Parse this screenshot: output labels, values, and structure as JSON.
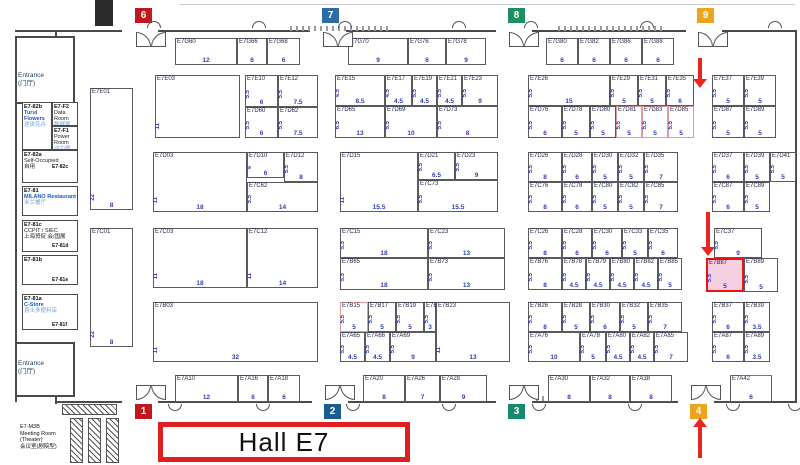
{
  "hall_label": "Hall E7",
  "colors": {
    "wall": "#4a4a4a",
    "booth_number_blue": "#2f3fb5",
    "highlight_fill": "#f6cfe3",
    "highlight_border": "#ee1212",
    "arrow_red": "#e8251f",
    "hall_label_border": "#e02020"
  },
  "badges": [
    {
      "n": "6",
      "color": "#c0181c",
      "x": 135,
      "y": 8
    },
    {
      "n": "7",
      "color": "#2c6da6",
      "x": 322,
      "y": 8
    },
    {
      "n": "8",
      "color": "#1e9060",
      "x": 508,
      "y": 8
    },
    {
      "n": "9",
      "color": "#eda31b",
      "x": 697,
      "y": 8
    },
    {
      "n": "1",
      "color": "#c0181c",
      "x": 135,
      "y": 404
    },
    {
      "n": "2",
      "color": "#1c5d8f",
      "x": 324,
      "y": 404
    },
    {
      "n": "3",
      "color": "#158a70",
      "x": 508,
      "y": 404
    },
    {
      "n": "4",
      "color": "#eda31b",
      "x": 690,
      "y": 404
    }
  ],
  "arrows": [
    {
      "x": 700,
      "y": 58,
      "h": 30,
      "dir": "down"
    },
    {
      "x": 708,
      "y": 212,
      "h": 44,
      "dir": "down"
    },
    {
      "x": 700,
      "y": 418,
      "h": 40,
      "dir": "up"
    }
  ],
  "booths": [
    {
      "id": "E7G60",
      "x": 175,
      "y": 38,
      "w": 62,
      "h": 27,
      "d": "",
      "n": "12"
    },
    {
      "id": "E7G66",
      "x": 237,
      "y": 38,
      "w": 30,
      "h": 27,
      "d": "",
      "n": "6"
    },
    {
      "id": "E7G68",
      "x": 267,
      "y": 38,
      "w": 33,
      "h": 27,
      "d": "",
      "n": "6"
    },
    {
      "id": "E7G70",
      "x": 348,
      "y": 38,
      "w": 60,
      "h": 27,
      "d": "",
      "n": "9"
    },
    {
      "id": "E7G76",
      "x": 408,
      "y": 38,
      "w": 38,
      "h": 27,
      "d": "",
      "n": "6"
    },
    {
      "id": "E7G78",
      "x": 446,
      "y": 38,
      "w": 40,
      "h": 27,
      "d": "",
      "n": "9"
    },
    {
      "id": "E7G80",
      "x": 546,
      "y": 38,
      "w": 32,
      "h": 27,
      "d": "",
      "n": "6"
    },
    {
      "id": "E7G82",
      "x": 578,
      "y": 38,
      "w": 32,
      "h": 27,
      "d": "",
      "n": "6"
    },
    {
      "id": "E7G86",
      "x": 610,
      "y": 38,
      "w": 32,
      "h": 27,
      "d": "",
      "n": "6"
    },
    {
      "id": "E7G88",
      "x": 642,
      "y": 38,
      "w": 32,
      "h": 27,
      "d": "",
      "n": "6"
    },
    {
      "id": "E7E01",
      "x": 90,
      "y": 88,
      "w": 43,
      "h": 122,
      "d": "22",
      "n": "8"
    },
    {
      "id": "E7C01",
      "x": 90,
      "y": 228,
      "w": 43,
      "h": 119,
      "d": "22",
      "n": "8"
    },
    {
      "id": "E7E03",
      "x": 155,
      "y": 75,
      "w": 85,
      "h": 63,
      "d": "11",
      "n": ""
    },
    {
      "id": "E7E10",
      "x": 245,
      "y": 75,
      "w": 33,
      "h": 32,
      "d": "5.5",
      "n": "6"
    },
    {
      "id": "E7E12",
      "x": 278,
      "y": 75,
      "w": 40,
      "h": 32,
      "d": "5.5",
      "n": "7.5"
    },
    {
      "id": "E7D60",
      "x": 245,
      "y": 107,
      "w": 33,
      "h": 31,
      "d": "5.5",
      "n": "6"
    },
    {
      "id": "E7D62",
      "x": 278,
      "y": 107,
      "w": 40,
      "h": 31,
      "d": "5.5",
      "n": "7.5"
    },
    {
      "id": "E7E15",
      "x": 335,
      "y": 75,
      "w": 50,
      "h": 31,
      "d": "4.5",
      "n": "8.5"
    },
    {
      "id": "E7E17",
      "x": 385,
      "y": 75,
      "w": 27,
      "h": 31,
      "d": "4.5",
      "n": "4.5"
    },
    {
      "id": "E7E19",
      "x": 412,
      "y": 75,
      "w": 25,
      "h": 31,
      "d": "5.5",
      "n": "4.5"
    },
    {
      "id": "E7E21",
      "x": 437,
      "y": 75,
      "w": 25,
      "h": 31,
      "d": "5.5",
      "n": "4.5"
    },
    {
      "id": "E7E23",
      "x": 462,
      "y": 75,
      "w": 36,
      "h": 31,
      "d": "5.5",
      "n": "9"
    },
    {
      "id": "E7D65",
      "x": 335,
      "y": 106,
      "w": 50,
      "h": 32,
      "d": "6.5",
      "n": "13"
    },
    {
      "id": "E7D69",
      "x": 385,
      "y": 106,
      "w": 52,
      "h": 32,
      "d": "5.5",
      "n": "10"
    },
    {
      "id": "E7D73",
      "x": 437,
      "y": 106,
      "w": 61,
      "h": 32,
      "d": "5.5",
      "n": "8"
    },
    {
      "id": "E7E26",
      "x": 528,
      "y": 75,
      "w": 82,
      "h": 31,
      "d": "5.5",
      "n": "15"
    },
    {
      "id": "E7E29",
      "x": 610,
      "y": 75,
      "w": 28,
      "h": 31,
      "d": "5.5",
      "n": "5"
    },
    {
      "id": "E7E31",
      "x": 638,
      "y": 75,
      "w": 28,
      "h": 31,
      "d": "5.5",
      "n": "5"
    },
    {
      "id": "E7E35",
      "x": 666,
      "y": 75,
      "w": 28,
      "h": 31,
      "d": "5.5",
      "n": "6"
    },
    {
      "id": "E7D76",
      "x": 528,
      "y": 106,
      "w": 34,
      "h": 32,
      "d": "5.5",
      "n": "6"
    },
    {
      "id": "E7D78",
      "x": 562,
      "y": 106,
      "w": 28,
      "h": 32,
      "d": "5.5",
      "n": "5"
    },
    {
      "id": "E7D80",
      "x": 590,
      "y": 106,
      "w": 26,
      "h": 32,
      "d": "5.5",
      "n": "5"
    },
    {
      "id": "E7D81",
      "x": 616,
      "y": 106,
      "w": 26,
      "h": 32,
      "d": "5.5",
      "n": "5",
      "cls": "pink"
    },
    {
      "id": "E7D83",
      "x": 642,
      "y": 106,
      "w": 26,
      "h": 32,
      "d": "5.5",
      "n": "5",
      "cls": "pink"
    },
    {
      "id": "E7D85",
      "x": 668,
      "y": 106,
      "w": 26,
      "h": 32,
      "d": "5.5",
      "n": "5",
      "cls": "pink"
    },
    {
      "id": "E7E37",
      "x": 712,
      "y": 75,
      "w": 32,
      "h": 31,
      "d": "5.5",
      "n": "5"
    },
    {
      "id": "E7E39",
      "x": 744,
      "y": 75,
      "w": 32,
      "h": 31,
      "d": "5.5",
      "n": "5"
    },
    {
      "id": "E7D87",
      "x": 712,
      "y": 106,
      "w": 32,
      "h": 32,
      "d": "5.5",
      "n": "5"
    },
    {
      "id": "E7D89",
      "x": 744,
      "y": 106,
      "w": 32,
      "h": 32,
      "d": "5.5",
      "n": "5"
    },
    {
      "id": "E7D03",
      "x": 153,
      "y": 152,
      "w": 94,
      "h": 60,
      "d": "11",
      "n": "18"
    },
    {
      "id": "E7D10",
      "x": 247,
      "y": 152,
      "w": 37,
      "h": 26,
      "d": "4",
      "n": "6"
    },
    {
      "id": "E7D12",
      "x": 284,
      "y": 152,
      "w": 34,
      "h": 30,
      "d": "5.5",
      "n": "8"
    },
    {
      "id": "E7C62",
      "x": 247,
      "y": 182,
      "w": 71,
      "h": 30,
      "d": "5.5",
      "n": "14"
    },
    {
      "id": "E7D15",
      "x": 340,
      "y": 152,
      "w": 78,
      "h": 60,
      "d": "11",
      "n": "15.5"
    },
    {
      "id": "E7D21",
      "x": 418,
      "y": 152,
      "w": 37,
      "h": 28,
      "d": "5.5",
      "n": "6.5"
    },
    {
      "id": "E7D23",
      "x": 455,
      "y": 152,
      "w": 43,
      "h": 28,
      "d": "5.5",
      "n": "9"
    },
    {
      "id": "E7C73",
      "x": 418,
      "y": 180,
      "w": 80,
      "h": 32,
      "d": "5.5",
      "n": "15.5"
    },
    {
      "id": "E7D26",
      "x": 528,
      "y": 152,
      "w": 34,
      "h": 30,
      "d": "5.5",
      "n": "8"
    },
    {
      "id": "E7D28",
      "x": 562,
      "y": 152,
      "w": 30,
      "h": 30,
      "d": "5.5",
      "n": "6"
    },
    {
      "id": "E7D30",
      "x": 592,
      "y": 152,
      "w": 26,
      "h": 30,
      "d": "5.5",
      "n": "5"
    },
    {
      "id": "E7D32",
      "x": 618,
      "y": 152,
      "w": 26,
      "h": 30,
      "d": "5.5",
      "n": "5"
    },
    {
      "id": "E7D35",
      "x": 644,
      "y": 152,
      "w": 34,
      "h": 30,
      "d": "5.5",
      "n": "7"
    },
    {
      "id": "E7C76",
      "x": 528,
      "y": 182,
      "w": 34,
      "h": 30,
      "d": "5.5",
      "n": "8"
    },
    {
      "id": "E7C78",
      "x": 562,
      "y": 182,
      "w": 30,
      "h": 30,
      "d": "5.5",
      "n": "6"
    },
    {
      "id": "E7C80",
      "x": 592,
      "y": 182,
      "w": 26,
      "h": 30,
      "d": "5.5",
      "n": "5"
    },
    {
      "id": "E7C82",
      "x": 618,
      "y": 182,
      "w": 26,
      "h": 30,
      "d": "5.5",
      "n": "5"
    },
    {
      "id": "E7C85",
      "x": 644,
      "y": 182,
      "w": 34,
      "h": 30,
      "d": "5.5",
      "n": "7"
    },
    {
      "id": "E7D37",
      "x": 712,
      "y": 152,
      "w": 32,
      "h": 30,
      "d": "5.5",
      "n": "6"
    },
    {
      "id": "E7D39",
      "x": 744,
      "y": 152,
      "w": 26,
      "h": 30,
      "d": "5.5",
      "n": "5"
    },
    {
      "id": "E7D41",
      "x": 770,
      "y": 152,
      "w": 26,
      "h": 30,
      "d": "5.5",
      "n": "5"
    },
    {
      "id": "E7C87",
      "x": 712,
      "y": 182,
      "w": 32,
      "h": 30,
      "d": "5.5",
      "n": "6"
    },
    {
      "id": "E7C89",
      "x": 744,
      "y": 182,
      "w": 26,
      "h": 30,
      "d": "5.5",
      "n": "5"
    },
    {
      "id": "E7C03",
      "x": 153,
      "y": 228,
      "w": 94,
      "h": 60,
      "d": "11",
      "n": "18"
    },
    {
      "id": "E7C12",
      "x": 247,
      "y": 228,
      "w": 71,
      "h": 60,
      "d": "11",
      "n": "14"
    },
    {
      "id": "E7C15",
      "x": 340,
      "y": 228,
      "w": 88,
      "h": 30,
      "d": "5.5",
      "n": "18"
    },
    {
      "id": "E7B65",
      "x": 340,
      "y": 258,
      "w": 88,
      "h": 32,
      "d": "5.5",
      "n": "18"
    },
    {
      "id": "E7C23",
      "x": 428,
      "y": 228,
      "w": 77,
      "h": 30,
      "d": "5.5",
      "n": "13"
    },
    {
      "id": "E7B73",
      "x": 428,
      "y": 258,
      "w": 77,
      "h": 32,
      "d": "5.5",
      "n": "13"
    },
    {
      "id": "E7C26",
      "x": 528,
      "y": 228,
      "w": 34,
      "h": 30,
      "d": "5.5",
      "n": "8"
    },
    {
      "id": "E7C28",
      "x": 562,
      "y": 228,
      "w": 30,
      "h": 30,
      "d": "5.5",
      "n": "6"
    },
    {
      "id": "E7C30",
      "x": 592,
      "y": 228,
      "w": 30,
      "h": 30,
      "d": "5.5",
      "n": "6"
    },
    {
      "id": "E7C33",
      "x": 622,
      "y": 228,
      "w": 26,
      "h": 30,
      "d": "5.5",
      "n": "5"
    },
    {
      "id": "E7C35",
      "x": 648,
      "y": 228,
      "w": 30,
      "h": 30,
      "d": "5.5",
      "n": "6"
    },
    {
      "id": "E7B76",
      "x": 528,
      "y": 258,
      "w": 34,
      "h": 32,
      "d": "5.5",
      "n": "8"
    },
    {
      "id": "E7B78",
      "x": 562,
      "y": 258,
      "w": 24,
      "h": 32,
      "d": "5.5",
      "n": "4.5"
    },
    {
      "id": "E7B79",
      "x": 586,
      "y": 258,
      "w": 24,
      "h": 32,
      "d": "5.5",
      "n": "4.5"
    },
    {
      "id": "E7B80",
      "x": 610,
      "y": 258,
      "w": 24,
      "h": 32,
      "d": "5.5",
      "n": "4.5"
    },
    {
      "id": "E7B82",
      "x": 634,
      "y": 258,
      "w": 24,
      "h": 32,
      "d": "5.5",
      "n": "4.5"
    },
    {
      "id": "E7B85",
      "x": 658,
      "y": 258,
      "w": 24,
      "h": 32,
      "d": "5.5",
      "n": "5"
    },
    {
      "id": "E7C37",
      "x": 714,
      "y": 228,
      "w": 48,
      "h": 30,
      "d": "5.5",
      "n": "9"
    },
    {
      "id": "E7B87",
      "x": 706,
      "y": 258,
      "w": 38,
      "h": 34,
      "d": "5.5",
      "n": "5",
      "cls": "hl"
    },
    {
      "id": "E7B89",
      "x": 744,
      "y": 258,
      "w": 34,
      "h": 34,
      "d": "5.5",
      "n": "5"
    },
    {
      "id": "E7B03",
      "x": 153,
      "y": 302,
      "w": 165,
      "h": 60,
      "d": "11",
      "n": "32"
    },
    {
      "id": "E7B15",
      "x": 340,
      "y": 302,
      "w": 28,
      "h": 30,
      "d": "5.5",
      "n": "5",
      "cls": "pink"
    },
    {
      "id": "E7B17",
      "x": 368,
      "y": 302,
      "w": 28,
      "h": 30,
      "d": "5.5",
      "n": "5"
    },
    {
      "id": "E7B19",
      "x": 396,
      "y": 302,
      "w": 28,
      "h": 30,
      "d": "5.5",
      "n": "5"
    },
    {
      "id": "E7B21",
      "x": 424,
      "y": 302,
      "w": 12,
      "h": 30,
      "d": "5.5",
      "n": "3"
    },
    {
      "id": "E7B23",
      "x": 436,
      "y": 302,
      "w": 74,
      "h": 60,
      "d": "11",
      "n": "13"
    },
    {
      "id": "E7A65",
      "x": 340,
      "y": 332,
      "w": 25,
      "h": 30,
      "d": "5.5",
      "n": "4.5"
    },
    {
      "id": "E7A66",
      "x": 365,
      "y": 332,
      "w": 25,
      "h": 30,
      "d": "5.5",
      "n": "4.5"
    },
    {
      "id": "E7A69",
      "x": 390,
      "y": 332,
      "w": 46,
      "h": 30,
      "d": "5.5",
      "n": "9"
    },
    {
      "id": "E7B26",
      "x": 528,
      "y": 302,
      "w": 34,
      "h": 30,
      "d": "5.5",
      "n": "8"
    },
    {
      "id": "E7B28",
      "x": 562,
      "y": 302,
      "w": 28,
      "h": 30,
      "d": "5.5",
      "n": "5"
    },
    {
      "id": "E7B30",
      "x": 590,
      "y": 302,
      "w": 30,
      "h": 30,
      "d": "5.5",
      "n": "6"
    },
    {
      "id": "E7B32",
      "x": 620,
      "y": 302,
      "w": 28,
      "h": 30,
      "d": "5.5",
      "n": "5"
    },
    {
      "id": "E7B35",
      "x": 648,
      "y": 302,
      "w": 34,
      "h": 30,
      "d": "5.5",
      "n": "7"
    },
    {
      "id": "E7A76",
      "x": 528,
      "y": 332,
      "w": 52,
      "h": 30,
      "d": "5.5",
      "n": "10"
    },
    {
      "id": "E7A78",
      "x": 580,
      "y": 332,
      "w": 26,
      "h": 30,
      "d": "5.5",
      "n": "5"
    },
    {
      "id": "E7A80",
      "x": 606,
      "y": 332,
      "w": 24,
      "h": 30,
      "d": "5.5",
      "n": "4.5"
    },
    {
      "id": "E7A82",
      "x": 630,
      "y": 332,
      "w": 24,
      "h": 30,
      "d": "5.5",
      "n": "4.5"
    },
    {
      "id": "E7A85",
      "x": 654,
      "y": 332,
      "w": 34,
      "h": 30,
      "d": "5.5",
      "n": "7"
    },
    {
      "id": "E7B37",
      "x": 712,
      "y": 302,
      "w": 32,
      "h": 30,
      "d": "5.5",
      "n": "6"
    },
    {
      "id": "E7B39",
      "x": 744,
      "y": 302,
      "w": 26,
      "h": 30,
      "d": "5.5",
      "n": "3.5"
    },
    {
      "id": "E7A87",
      "x": 712,
      "y": 332,
      "w": 32,
      "h": 30,
      "d": "5.5",
      "n": "6"
    },
    {
      "id": "E7A89",
      "x": 744,
      "y": 332,
      "w": 26,
      "h": 30,
      "d": "5.5",
      "n": "3.5"
    },
    {
      "id": "E7A10",
      "x": 175,
      "y": 375,
      "w": 63,
      "h": 27,
      "d": "",
      "n": "12"
    },
    {
      "id": "E7A16",
      "x": 238,
      "y": 375,
      "w": 30,
      "h": 27,
      "d": "",
      "n": "6"
    },
    {
      "id": "E7A18",
      "x": 268,
      "y": 375,
      "w": 32,
      "h": 27,
      "d": "",
      "n": "6"
    },
    {
      "id": "E7A20",
      "x": 363,
      "y": 375,
      "w": 42,
      "h": 27,
      "d": "",
      "n": "8"
    },
    {
      "id": "E7A26",
      "x": 405,
      "y": 375,
      "w": 35,
      "h": 27,
      "d": "",
      "n": "7"
    },
    {
      "id": "E7A28",
      "x": 440,
      "y": 375,
      "w": 47,
      "h": 27,
      "d": "",
      "n": "9"
    },
    {
      "id": "E7A30",
      "x": 548,
      "y": 375,
      "w": 42,
      "h": 27,
      "d": "",
      "n": "8"
    },
    {
      "id": "E7A32",
      "x": 590,
      "y": 375,
      "w": 40,
      "h": 27,
      "d": "",
      "n": "8"
    },
    {
      "id": "E7A38",
      "x": 630,
      "y": 375,
      "w": 42,
      "h": 27,
      "d": "",
      "n": "8"
    },
    {
      "id": "E7A42",
      "x": 730,
      "y": 375,
      "w": 42,
      "h": 27,
      "d": "",
      "n": "6",
      "cls": "redtop"
    }
  ],
  "rooms": [
    {
      "x": 15,
      "y": 36,
      "w": 60,
      "h": 68,
      "cls": "entrance",
      "lines": [
        {
          "t": "Entrance",
          "s": "nav"
        },
        {
          "t": "(门厅)",
          "s": "nav"
        }
      ],
      "pad": 34
    },
    {
      "x": 22,
      "y": 102,
      "w": 30,
      "h": 48,
      "lines": [
        {
          "t": "E7-82b",
          "s": "k"
        },
        {
          "t": "Turui",
          "s": "b"
        },
        {
          "t": "Flowers",
          "s": "b"
        },
        {
          "t": "途锐花卉",
          "s": "lb"
        }
      ]
    },
    {
      "x": 52,
      "y": 102,
      "w": 26,
      "h": 24,
      "lines": [
        {
          "t": "E7-F2",
          "s": "k"
        },
        {
          "t": "Data Room",
          "s": "n"
        },
        {
          "t": "数据室",
          "s": "lb"
        }
      ]
    },
    {
      "x": 52,
      "y": 126,
      "w": 26,
      "h": 24,
      "lines": [
        {
          "t": "E7-F1",
          "s": "k"
        },
        {
          "t": "Power Room",
          "s": "n"
        },
        {
          "t": "动力房",
          "s": "lb"
        }
      ]
    },
    {
      "x": 22,
      "y": 150,
      "w": 56,
      "h": 33,
      "lines": [
        {
          "t": "E7-82a",
          "s": "k"
        },
        {
          "t": "Self-Occupied",
          "s": "n"
        },
        {
          "t": "自用",
          "s": "n"
        }
      ]
    },
    {
      "x": 22,
      "y": 186,
      "w": 56,
      "h": 30,
      "lines": [
        {
          "t": "E7-81",
          "s": "k"
        },
        {
          "t": "MILANO Restaurant",
          "s": "b"
        },
        {
          "t": "米兰餐厅",
          "s": "lb"
        }
      ]
    },
    {
      "x": 22,
      "y": 220,
      "w": 56,
      "h": 32,
      "lines": [
        {
          "t": "E7-81c",
          "s": "k"
        },
        {
          "t": "CCPIT / SIEC",
          "s": "n"
        },
        {
          "t": "上海贸促 会/国展",
          "s": "n"
        }
      ]
    },
    {
      "x": 22,
      "y": 255,
      "w": 56,
      "h": 30,
      "lines": [
        {
          "t": "E7-81b",
          "s": "k"
        }
      ]
    },
    {
      "x": 22,
      "y": 294,
      "w": 56,
      "h": 36,
      "lines": [
        {
          "t": "E7-81a",
          "s": "k"
        },
        {
          "t": "C-Store",
          "s": "b"
        },
        {
          "t": "喜士多便利店",
          "s": "lb"
        }
      ]
    },
    {
      "x": 15,
      "y": 342,
      "w": 60,
      "h": 55,
      "cls": "entrance",
      "lines": [
        {
          "t": "Entrance",
          "s": "nav"
        },
        {
          "t": "(门厅)",
          "s": "nav"
        }
      ],
      "pad": 16
    }
  ],
  "corner_labels": [
    {
      "t": "E7-82c",
      "x": 52,
      "y": 164
    },
    {
      "t": "E7-81d",
      "x": 52,
      "y": 243
    },
    {
      "t": "E7-81e",
      "x": 52,
      "y": 277
    },
    {
      "t": "E7-81f",
      "x": 52,
      "y": 322
    }
  ],
  "meeting_room": {
    "x": 20,
    "y": 424,
    "lines": [
      "E7-M3B",
      "Meeting Room",
      "(Theater)",
      "会议室(剧院型)"
    ]
  }
}
